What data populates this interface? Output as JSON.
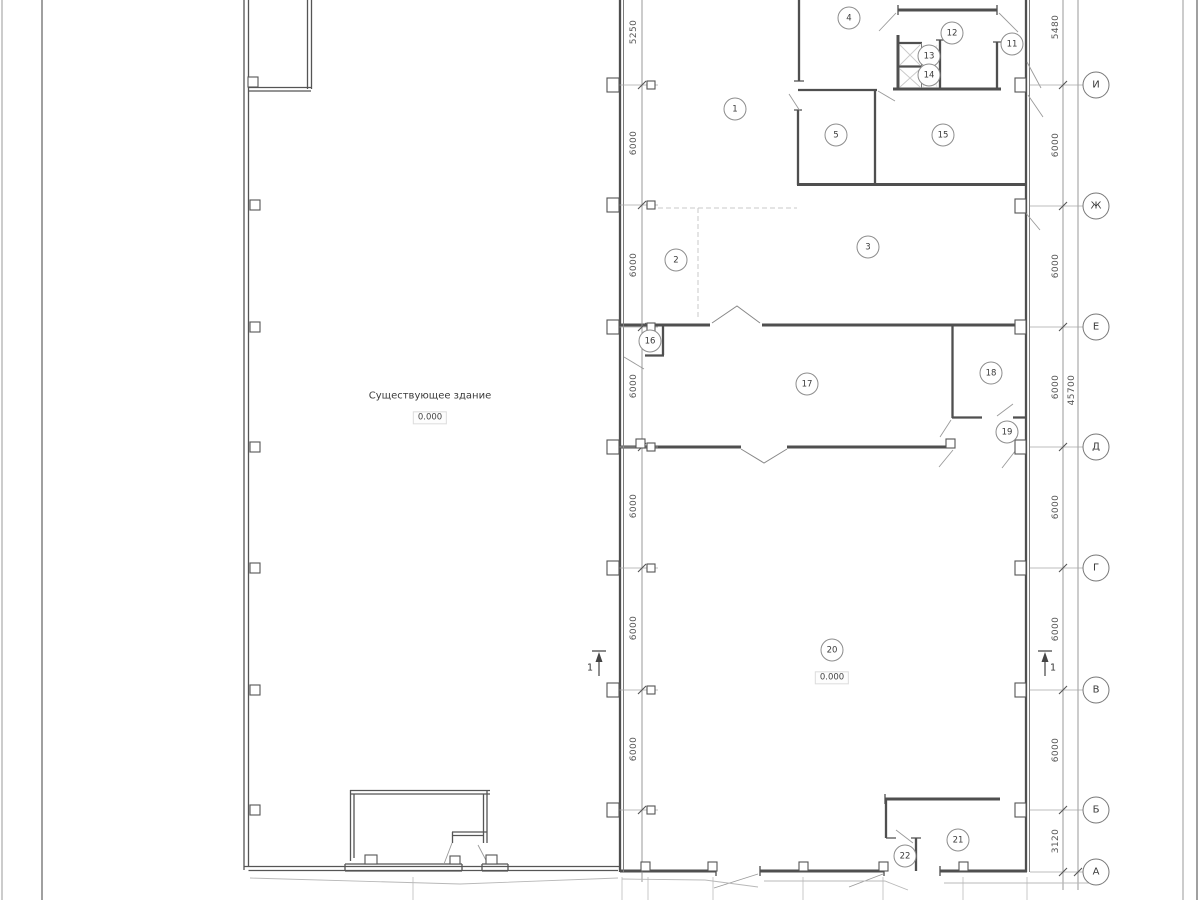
{
  "drawing": {
    "existing_building_label": "Существующее здание",
    "existing_building_elevation": "0.000",
    "hall_elevation": "0.000",
    "section_left": "1",
    "section_right": "1",
    "wall_color": "#4f4f4f",
    "light_line_color": "#9a9a9a"
  },
  "axis_x": 1096,
  "axes": [
    {
      "label": "И",
      "y": 85
    },
    {
      "label": "Ж",
      "y": 206
    },
    {
      "label": "Е",
      "y": 327
    },
    {
      "label": "Д",
      "y": 447
    },
    {
      "label": "Г",
      "y": 568
    },
    {
      "label": "В",
      "y": 690
    },
    {
      "label": "Б",
      "y": 810
    },
    {
      "label": "А",
      "y": 872
    }
  ],
  "rooms": [
    {
      "n": "1",
      "x": 735,
      "y": 109
    },
    {
      "n": "2",
      "x": 676,
      "y": 260
    },
    {
      "n": "3",
      "x": 868,
      "y": 247
    },
    {
      "n": "4",
      "x": 849,
      "y": 18
    },
    {
      "n": "5",
      "x": 836,
      "y": 135
    },
    {
      "n": "11",
      "x": 1012,
      "y": 44
    },
    {
      "n": "12",
      "x": 952,
      "y": 33
    },
    {
      "n": "13",
      "x": 929,
      "y": 56
    },
    {
      "n": "14",
      "x": 929,
      "y": 75
    },
    {
      "n": "15",
      "x": 943,
      "y": 135
    },
    {
      "n": "16",
      "x": 650,
      "y": 341
    },
    {
      "n": "17",
      "x": 807,
      "y": 384
    },
    {
      "n": "18",
      "x": 991,
      "y": 373
    },
    {
      "n": "19",
      "x": 1007,
      "y": 432
    },
    {
      "n": "20",
      "x": 832,
      "y": 650
    },
    {
      "n": "21",
      "x": 958,
      "y": 840
    },
    {
      "n": "22",
      "x": 905,
      "y": 856
    }
  ],
  "left_dims": {
    "x": 634,
    "items": [
      {
        "v": "5250",
        "y": 32
      },
      {
        "v": "6000",
        "y": 143
      },
      {
        "v": "6000",
        "y": 265
      },
      {
        "v": "6000",
        "y": 386
      },
      {
        "v": "6000",
        "y": 506
      },
      {
        "v": "6000",
        "y": 628
      },
      {
        "v": "6000",
        "y": 749
      }
    ]
  },
  "right_dims": {
    "x": 1056,
    "items": [
      {
        "v": "5480",
        "y": 27
      },
      {
        "v": "6000",
        "y": 145
      },
      {
        "v": "6000",
        "y": 266
      },
      {
        "v": "6000",
        "y": 387
      },
      {
        "v": "6000",
        "y": 507
      },
      {
        "v": "6000",
        "y": 629
      },
      {
        "v": "6000",
        "y": 750
      },
      {
        "v": "3120",
        "y": 841
      }
    ]
  },
  "right_total": {
    "v": "45700",
    "x": 1072,
    "y": 390
  }
}
